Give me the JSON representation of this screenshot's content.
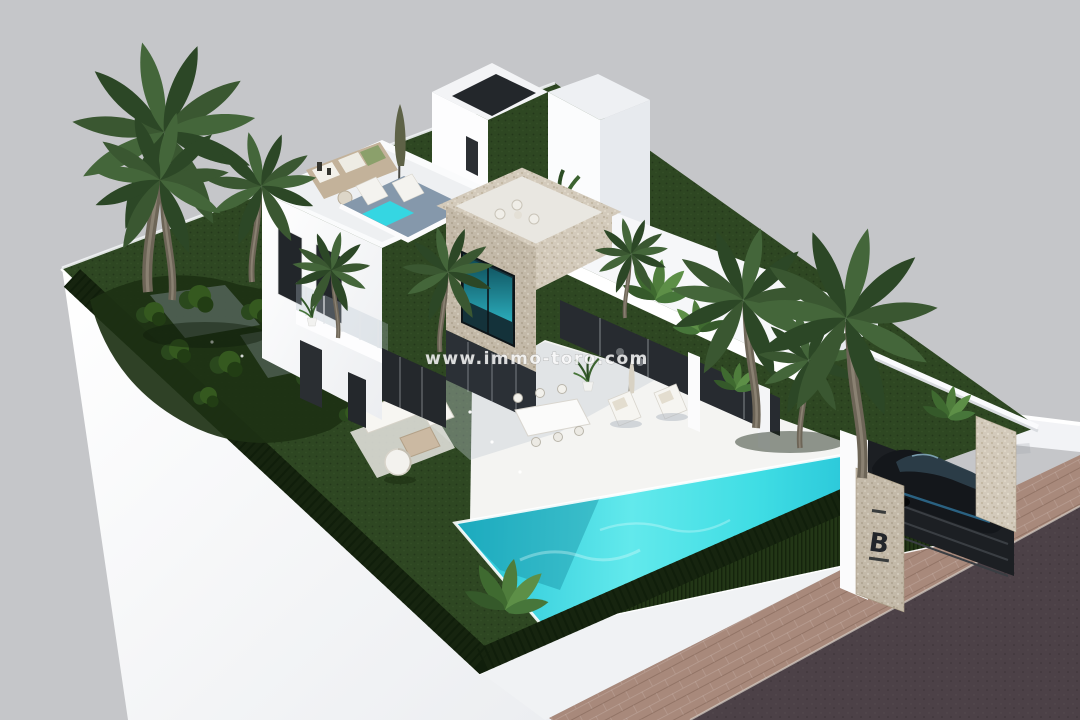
{
  "scene": {
    "type": "3d-architectural-exterior-render",
    "subject": "Modern white villa with rooftop terraces, stone tower, garden and turquoise pool",
    "watermark": {
      "text": "www.immo-toro.com"
    },
    "entrance_sign": {
      "letter": "B"
    },
    "palette": {
      "background": "#c5c6c9",
      "villa_white": "#ffffff",
      "villa_shade": "#e7e9ec",
      "stone_clad_light": "#d3cabb",
      "stone_clad_shade": "#c3b9a8",
      "lawn": "#2e4722",
      "hedge": "#16240f",
      "pool_light": "#62e9ec",
      "pool_dark": "#12aecd",
      "road": "#4c4147",
      "sidewalk_pavers": "#a8897b",
      "window_glass": "#22262a",
      "car_body": "#14171b",
      "car_accent": "#2f6f93"
    }
  }
}
